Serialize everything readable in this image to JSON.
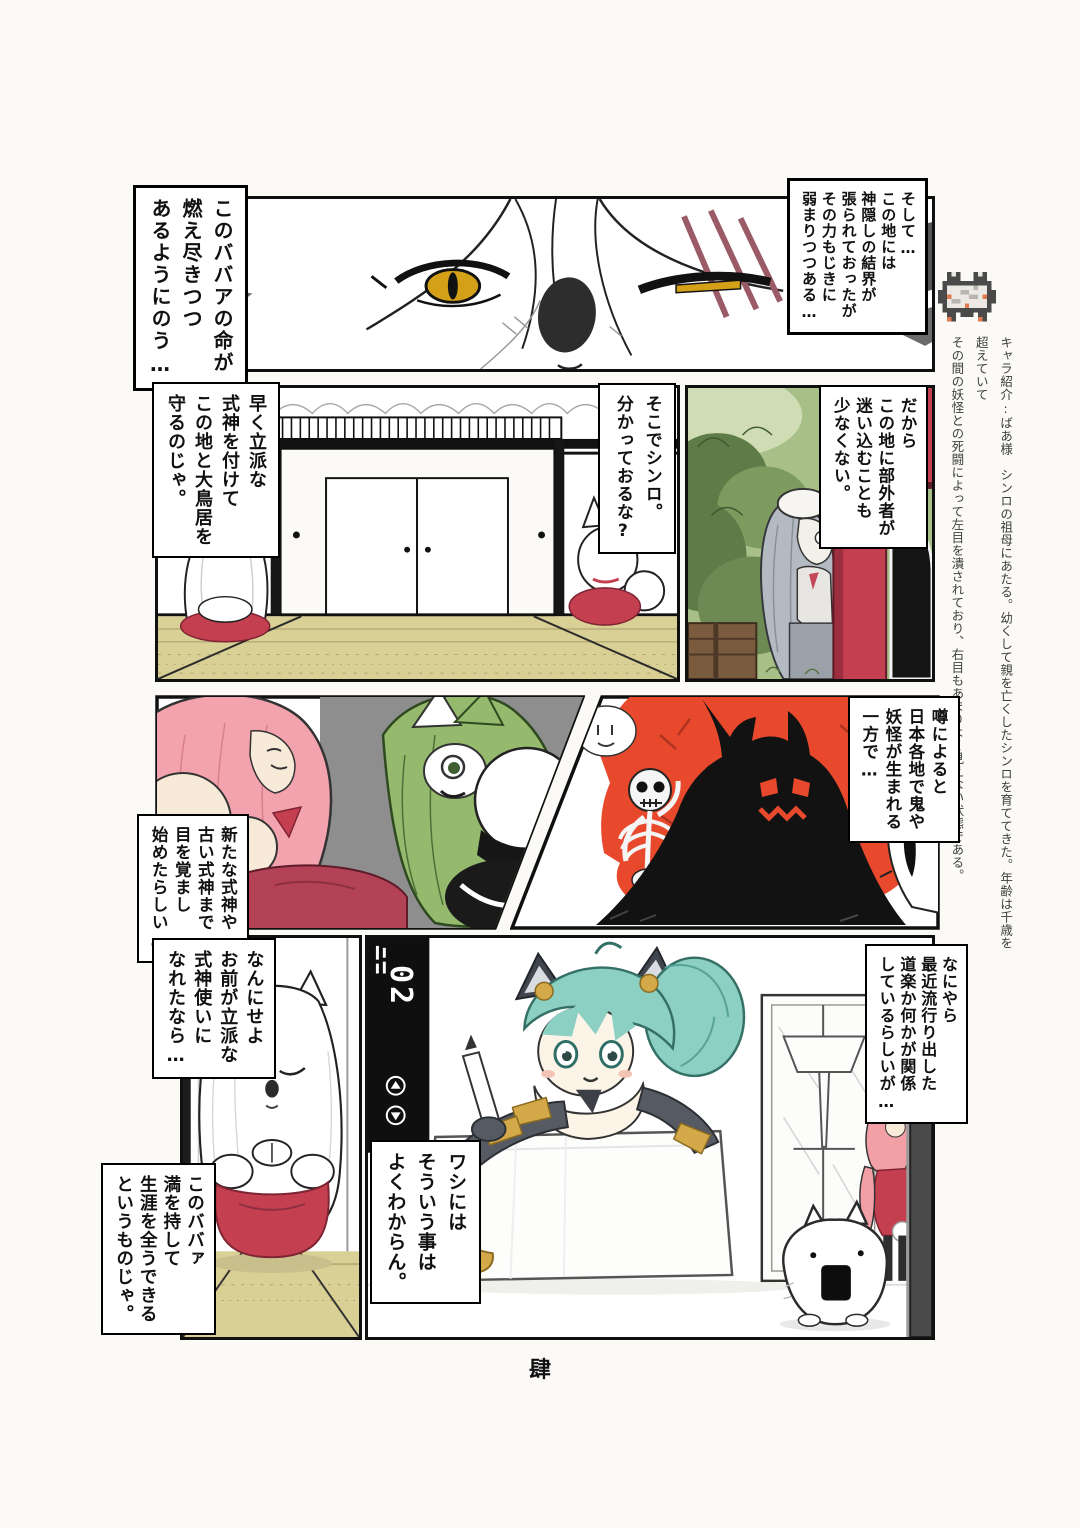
{
  "page": {
    "number_label": "肆"
  },
  "colors": {
    "red": "#c43f50",
    "dark_red": "#7e2433",
    "monster_red": "#e8492c",
    "green": "#95ba6d",
    "pink": "#f2a3ae",
    "teal": "#8ccfc3",
    "gold": "#d4a94a",
    "tatami": "#d9d096",
    "eye_gold": "#d4a018",
    "ink": "#111111",
    "paper": "#fbfaf7"
  },
  "margin_note": {
    "text": "キャラ紹介:ばあ様　シンロの祖母にあたる。幼くして親を亡くしたシンロを育ててきた。年齢は千歳を超えていて\nその間の妖怪との死闘によって左目を潰されており、右目もあまりよく見えない状態である。"
  },
  "bubbles": {
    "b1": {
      "text": "このババアの命が\n燃え尽きつつ\nあるようにのう…"
    },
    "b2": {
      "text": "そして…\nこの地には\n神隠しの結界が\n張られておったが\nその力もじきに\n弱まりつつある…"
    },
    "b3": {
      "text": "早く立派な\n式神を付けて\nこの地と大鳥居を\n守るのじゃ。"
    },
    "b4": {
      "text": "そこでシンロ。\n分かっておるな?"
    },
    "b5": {
      "text": "だから\nこの地に部外者が\n迷い込むことも\n少なくない。"
    },
    "b6": {
      "text": "噂によると\n日本各地で鬼や\n妖怪が生まれる\n一方で…"
    },
    "b7": {
      "text": "新たな式神や\n古い式神まで\n目を覚まし\n始めたらしい…"
    },
    "b8": {
      "text": "なんにせよ\nお前が立派な\n式神使いに\nなれたなら…"
    },
    "b9": {
      "text": "なにやら\n最近流行り出した\n道楽か何かが関係\nしているらしいが…"
    },
    "b10": {
      "text": "このババァ\n満を持して\n生涯を全うできる\nというものじゃ。"
    },
    "b11": {
      "text": "ワシには\nそういう事は\nよくわからん。"
    }
  },
  "panel7": {
    "elevator_display": "02"
  }
}
